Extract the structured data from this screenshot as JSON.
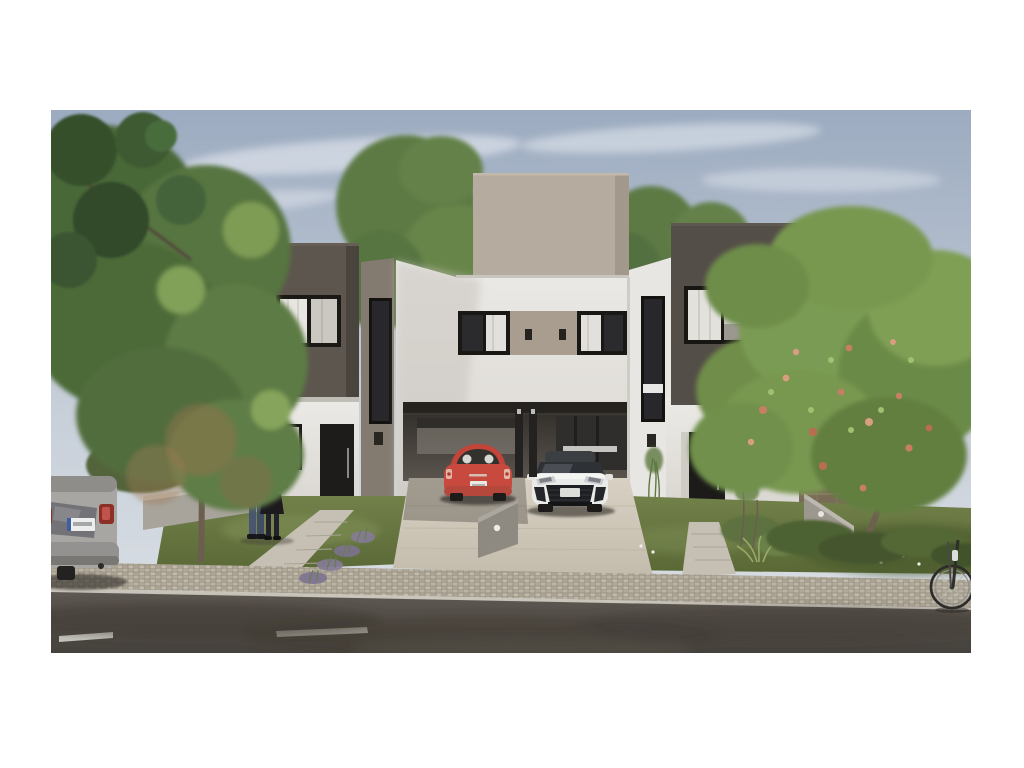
{
  "meta": {
    "domain": "architectural-exterior-render",
    "alt": "Street-level architectural rendering of modern two-story duplex townhouses: dark warm-gray upper volumes with curtained windows, white lower walls, a central beige stair tower, a dark carport beam sheltering a red city car and a white hot hatch on a concrete driveway, a couple holding a child by the left entrance walkway, lavender and white-flowering shrubs in low concrete planters, large trees framing both sides, a silver car parked at the left curb, a bicycle front wheel entering at right, cobblestone sidewalk and asphalt street with dashed white lane markings in the foreground."
  },
  "scene": {
    "sky": {
      "top_color": "#9cabc0",
      "horizon_color": "#dde1e6",
      "cloud_color": "#eef1f5"
    },
    "buildings": [
      {
        "id": "left-duplex-unit",
        "upper_volume_color": "#5d564e",
        "facade_panel_color": "#968d80",
        "lower_wall_color": "#eae8e4",
        "door_color": "#1d1c1a",
        "window_frame_color": "#1a1916",
        "curtain_color": "#e8e6e1"
      },
      {
        "id": "center-duplex-unit",
        "tower_color": "#b5ab9e",
        "wall_color": "#e9e7e3",
        "window_band_panel_color": "#a89d8f",
        "carport_beam_color": "#26231f"
      },
      {
        "id": "right-duplex-unit",
        "upper_volume_color": "#544e48",
        "facade_panel_color": "#8f867c",
        "lower_wall_color": "#eae8e4",
        "door_color": "#1c1b19",
        "stone_accent_color": "#7a6b57"
      },
      {
        "id": "neighbor-house",
        "wall_color": "#d8d3cb"
      }
    ],
    "vehicles": [
      {
        "id": "red-city-car",
        "type": "compact hatchback parked under carport",
        "body_color": "#c84a3f"
      },
      {
        "id": "white-hot-hatch",
        "type": "hatchback on driveway",
        "body_color": "#eaeae8",
        "roof_color": "#3c3f42",
        "grille_color": "#1e1f22"
      },
      {
        "id": "silver-parked-car",
        "type": "car parked at left curb, rear view",
        "body_color": "#a7a6a3",
        "taillight_color": "#8c2f27"
      },
      {
        "id": "bicycle",
        "visible_part": "front wheel and fork at right edge",
        "frame_color": "#2c2b29"
      }
    ],
    "people": [
      {
        "id": "man",
        "top_color": "#2c3342",
        "pants_color": "#49566e"
      },
      {
        "id": "woman",
        "top_color": "#dd8c7e",
        "skirt_color": "#1c1a1d"
      },
      {
        "id": "child",
        "held_by": "woman"
      }
    ],
    "landscape": {
      "lawn_color": "#66763e",
      "foliage_colors": [
        "#4a6838",
        "#6f8e4a",
        "#7a9b52",
        "#2f4727"
      ],
      "flowering_tree_blossom_color": "#c77f63",
      "shrub_flower_color": "#eef0e8",
      "lavender_color": "#857b97",
      "planter_concrete_color": "#a8a49c",
      "trunk_color": "#6e604f"
    },
    "hardscape": {
      "driveway_color": "#cfc8ba",
      "sidewalk_paver_color": "#b6afa1",
      "walkway_color": "#c6c0b4",
      "asphalt_color": "#534e48",
      "lane_dash_color": "#d8d6d0",
      "divider_wall_color": "#8e8981"
    },
    "lighting": {
      "wall_sconce_color": "#2a2722",
      "ground_light_color": "#e8e6df"
    }
  }
}
